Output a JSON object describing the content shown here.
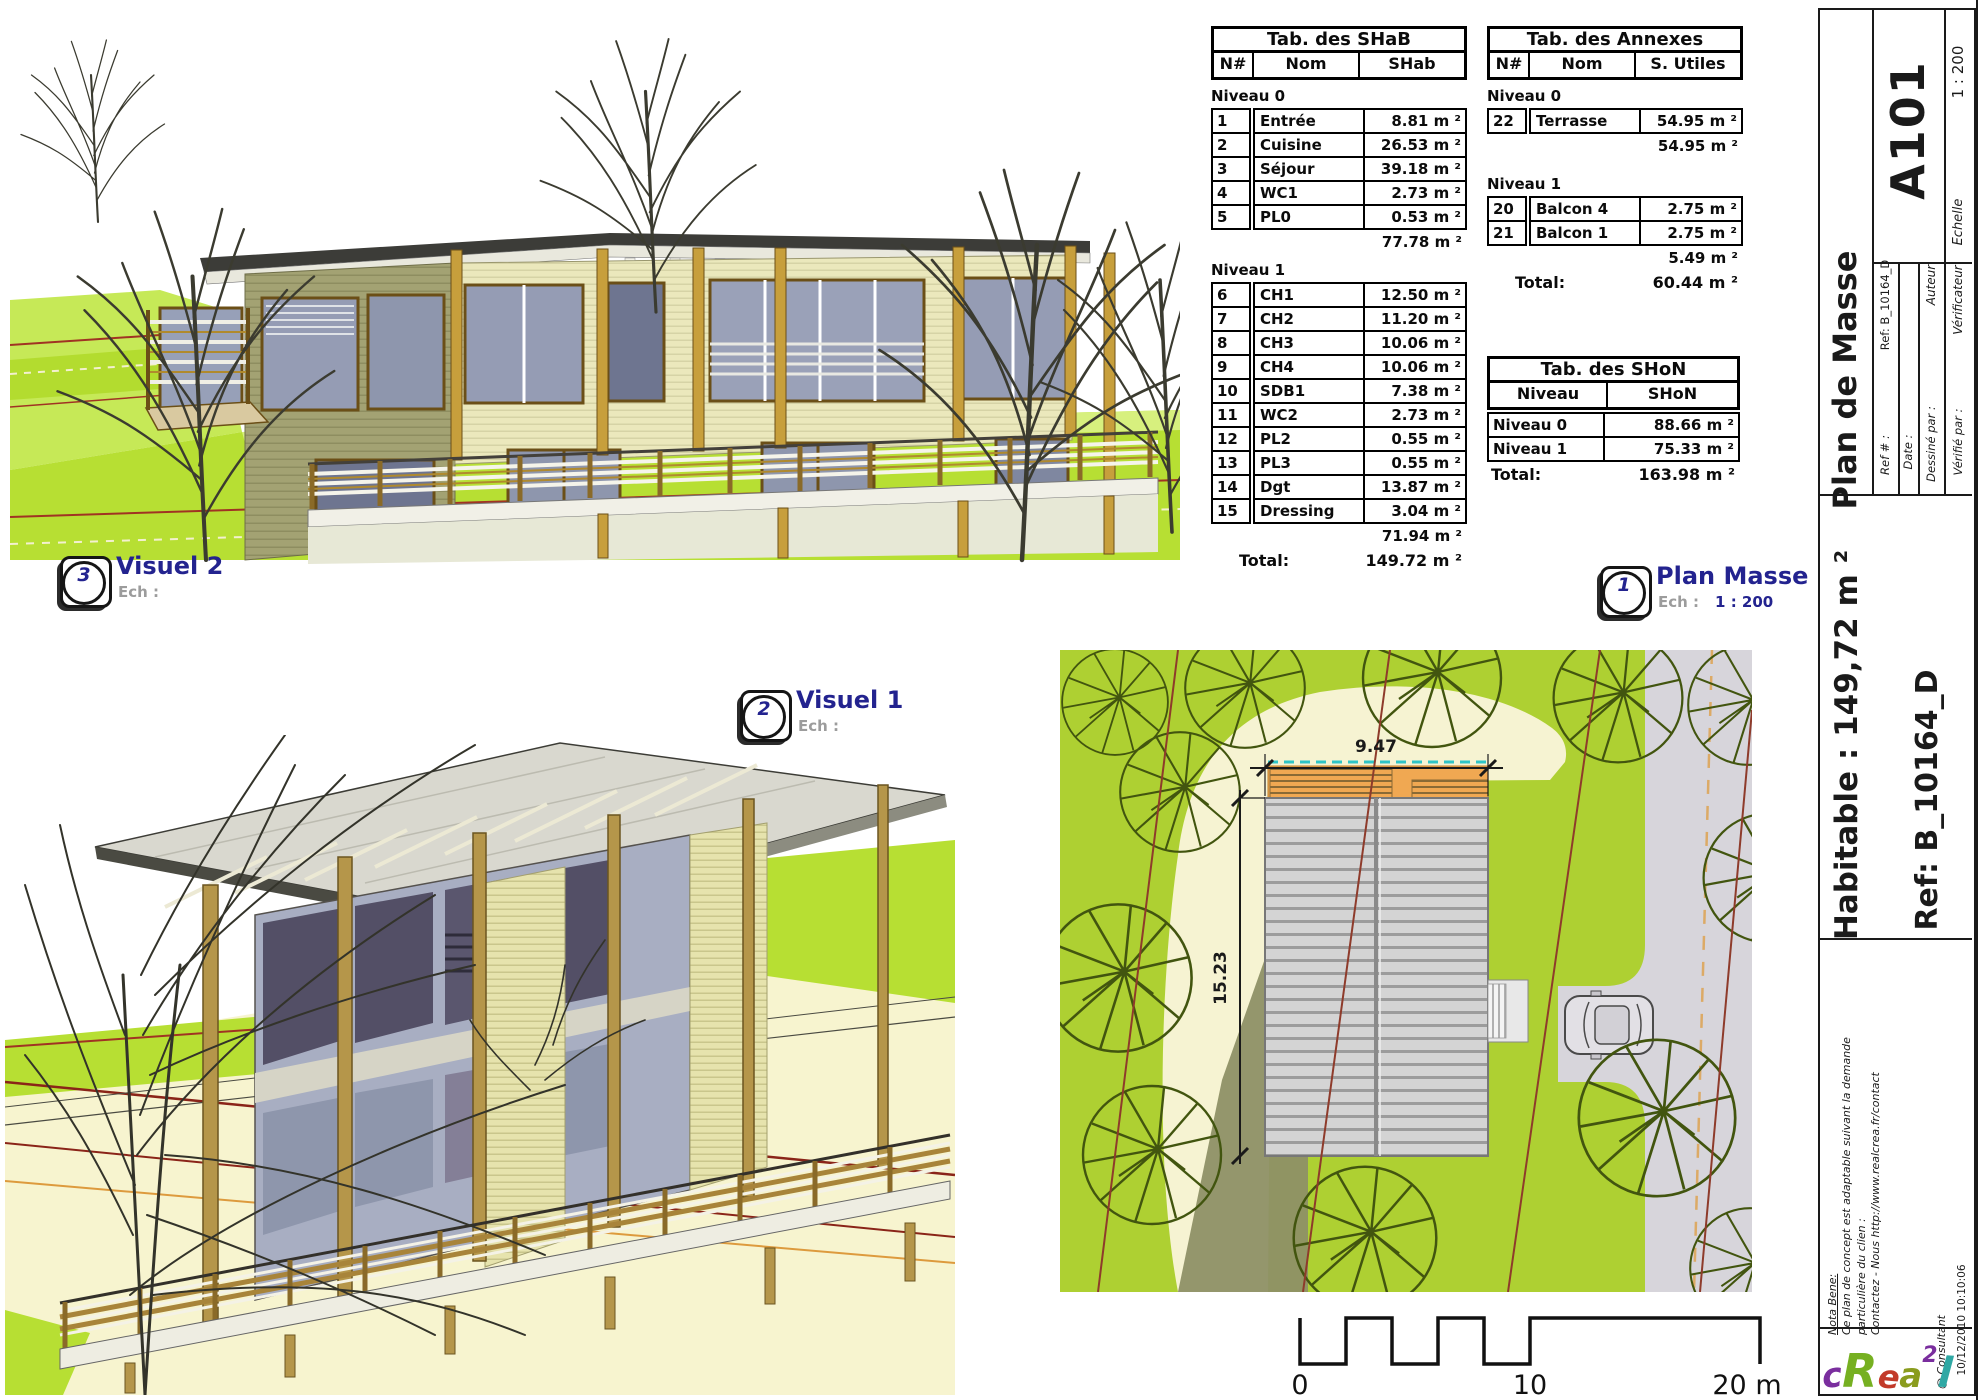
{
  "colors": {
    "accent_navy": "#23238f",
    "label_gray": "#9c9c9c",
    "grass_green": "#aed032",
    "lime_green": "#c6e957",
    "cream_field": "#f6f3d2",
    "road_gray": "#d7d5db",
    "roof_gray": "#cfcfcf",
    "terrace_orange": "#f0a852",
    "contour_red": "#8e3b2b",
    "teal_dash": "#2ec4c6",
    "wood_gold": "#c79f3c",
    "logo_colors": [
      "#7a2e9e",
      "#76b021",
      "#c23a2a",
      "#8a9c1e",
      "#7a2e9e",
      "#2fa8a4"
    ]
  },
  "views": {
    "visuel2": {
      "num": "3",
      "title": "Visuel 2",
      "ech_label": "Ech :",
      "ech_value": ""
    },
    "visuel1": {
      "num": "2",
      "title": "Visuel 1",
      "ech_label": "Ech :",
      "ech_value": ""
    },
    "plan_masse": {
      "num": "1",
      "title": "Plan Masse",
      "ech_label": "Ech :",
      "ech_value": "1 : 200"
    }
  },
  "tables": {
    "shab": {
      "title": "Tab. des SHaB",
      "h": [
        "N#",
        "Nom",
        "SHab"
      ],
      "n0": {
        "label": "Niveau 0",
        "rows": [
          [
            "1",
            "Entrée",
            "8.81 m ²"
          ],
          [
            "2",
            "Cuisine",
            "26.53 m ²"
          ],
          [
            "3",
            "Séjour",
            "39.18 m ²"
          ],
          [
            "4",
            "WC1",
            "2.73 m ²"
          ],
          [
            "5",
            "PL0",
            "0.53 m ²"
          ]
        ],
        "subtotal": "77.78 m ²"
      },
      "n1": {
        "label": "Niveau 1",
        "rows": [
          [
            "6",
            "CH1",
            "12.50 m ²"
          ],
          [
            "7",
            "CH2",
            "11.20 m ²"
          ],
          [
            "8",
            "CH3",
            "10.06 m ²"
          ],
          [
            "9",
            "CH4",
            "10.06 m ²"
          ],
          [
            "10",
            "SDB1",
            "7.38 m ²"
          ],
          [
            "11",
            "WC2",
            "2.73 m ²"
          ],
          [
            "12",
            "PL2",
            "0.55 m ²"
          ],
          [
            "13",
            "PL3",
            "0.55 m ²"
          ],
          [
            "14",
            "Dgt",
            "13.87 m ²"
          ],
          [
            "15",
            "Dressing",
            "3.04 m ²"
          ]
        ],
        "subtotal": "71.94 m ²"
      },
      "total_label": "Total:",
      "total": "149.72 m ²"
    },
    "annexes": {
      "title": "Tab. des Annexes",
      "h": [
        "N#",
        "Nom",
        "S. Utiles"
      ],
      "n0": {
        "label": "Niveau 0",
        "rows": [
          [
            "22",
            "Terrasse",
            "54.95 m ²"
          ]
        ],
        "subtotal": "54.95 m ²"
      },
      "n1": {
        "label": "Niveau 1",
        "rows": [
          [
            "20",
            "Balcon 4",
            "2.75 m ²"
          ],
          [
            "21",
            "Balcon 1",
            "2.75 m ²"
          ]
        ],
        "subtotal": "5.49 m ²"
      },
      "total_label": "Total:",
      "total": "60.44 m ²"
    },
    "shon": {
      "title": "Tab. des SHoN",
      "h": [
        "Niveau",
        "SHoN"
      ],
      "rows": [
        [
          "Niveau 0",
          "88.66 m ²"
        ],
        [
          "Niveau 1",
          "75.33 m ²"
        ]
      ],
      "total_label": "Total:",
      "total": "163.98 m ²"
    }
  },
  "site_plan": {
    "dim_width": "9.47",
    "dim_height": "15.23"
  },
  "scale_bar": {
    "zero": "0",
    "ten": "10",
    "twenty": "20 m"
  },
  "title_block": {
    "sheet_title": "Plan de Masse",
    "sheet_number": "A101",
    "scale_label": "Echelle",
    "scale_value": "1 : 200",
    "ref_label": "Ref # :",
    "ref_value": "Ref: B_10164_D",
    "date_label": "Date :",
    "drawn_label": "Dessiné par :",
    "drawn_value": "Auteur",
    "checked_label": "Vérifié par :",
    "checked_value": "Vérificateur",
    "habitable": "Habitable : 149,72 m ²",
    "ref_big": "Ref: B_10164_D",
    "nota_title": "Nota Bene:",
    "nota_line1": "Ce plan de concept est adaptable suivant la demande",
    "nota_line2": "particulière du clien :",
    "nota_line3": "Contactez - Nous http://www.realcrea.fr/contact",
    "consultant": "@ Consultant",
    "timestamp": "10/12/2010 10:10:06",
    "logo_letters": [
      "c",
      "R",
      "e",
      "a",
      "2",
      "l"
    ]
  }
}
